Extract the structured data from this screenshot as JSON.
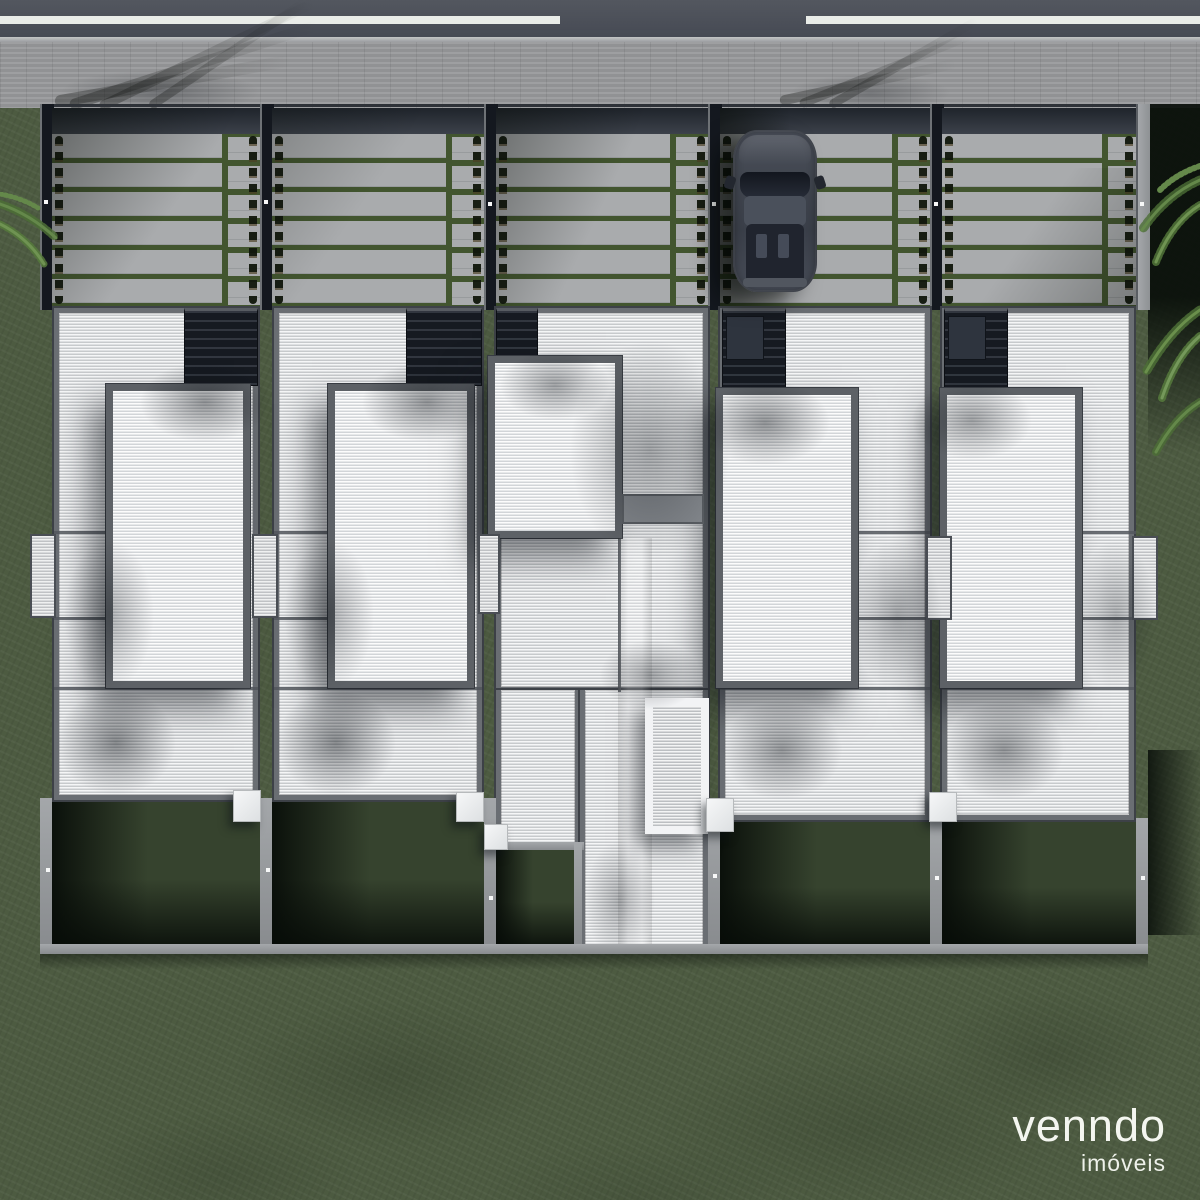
{
  "brand": {
    "name": "venndo",
    "tagline": "imóveis",
    "text_color": "#f4f6f0"
  },
  "scene": {
    "type": "top-view 3d render of rowhouse condominium",
    "units_count": 5,
    "street": {
      "lane_marking": "dashed white line",
      "road_color": "#4a4e58",
      "sidewalk_color": "#999a9c"
    },
    "car": {
      "present": true,
      "body_color": "#3f444f",
      "location": "driveway of unit 4"
    },
    "landscape": {
      "lawn_color": "#4d5b41",
      "grass_joint_color": "#42552f",
      "palm_frond_color": "#64884a"
    },
    "buildings": {
      "roof_color": "#dfe1e3",
      "roof_frame_color": "#6a6e73",
      "garage_pergola_color": "#161a21",
      "boundary_wall_color": "#a4a7aa",
      "pool_pergola_frame_color": "#f2f3f5",
      "ac_unit_color": "#f6f7f8"
    }
  }
}
